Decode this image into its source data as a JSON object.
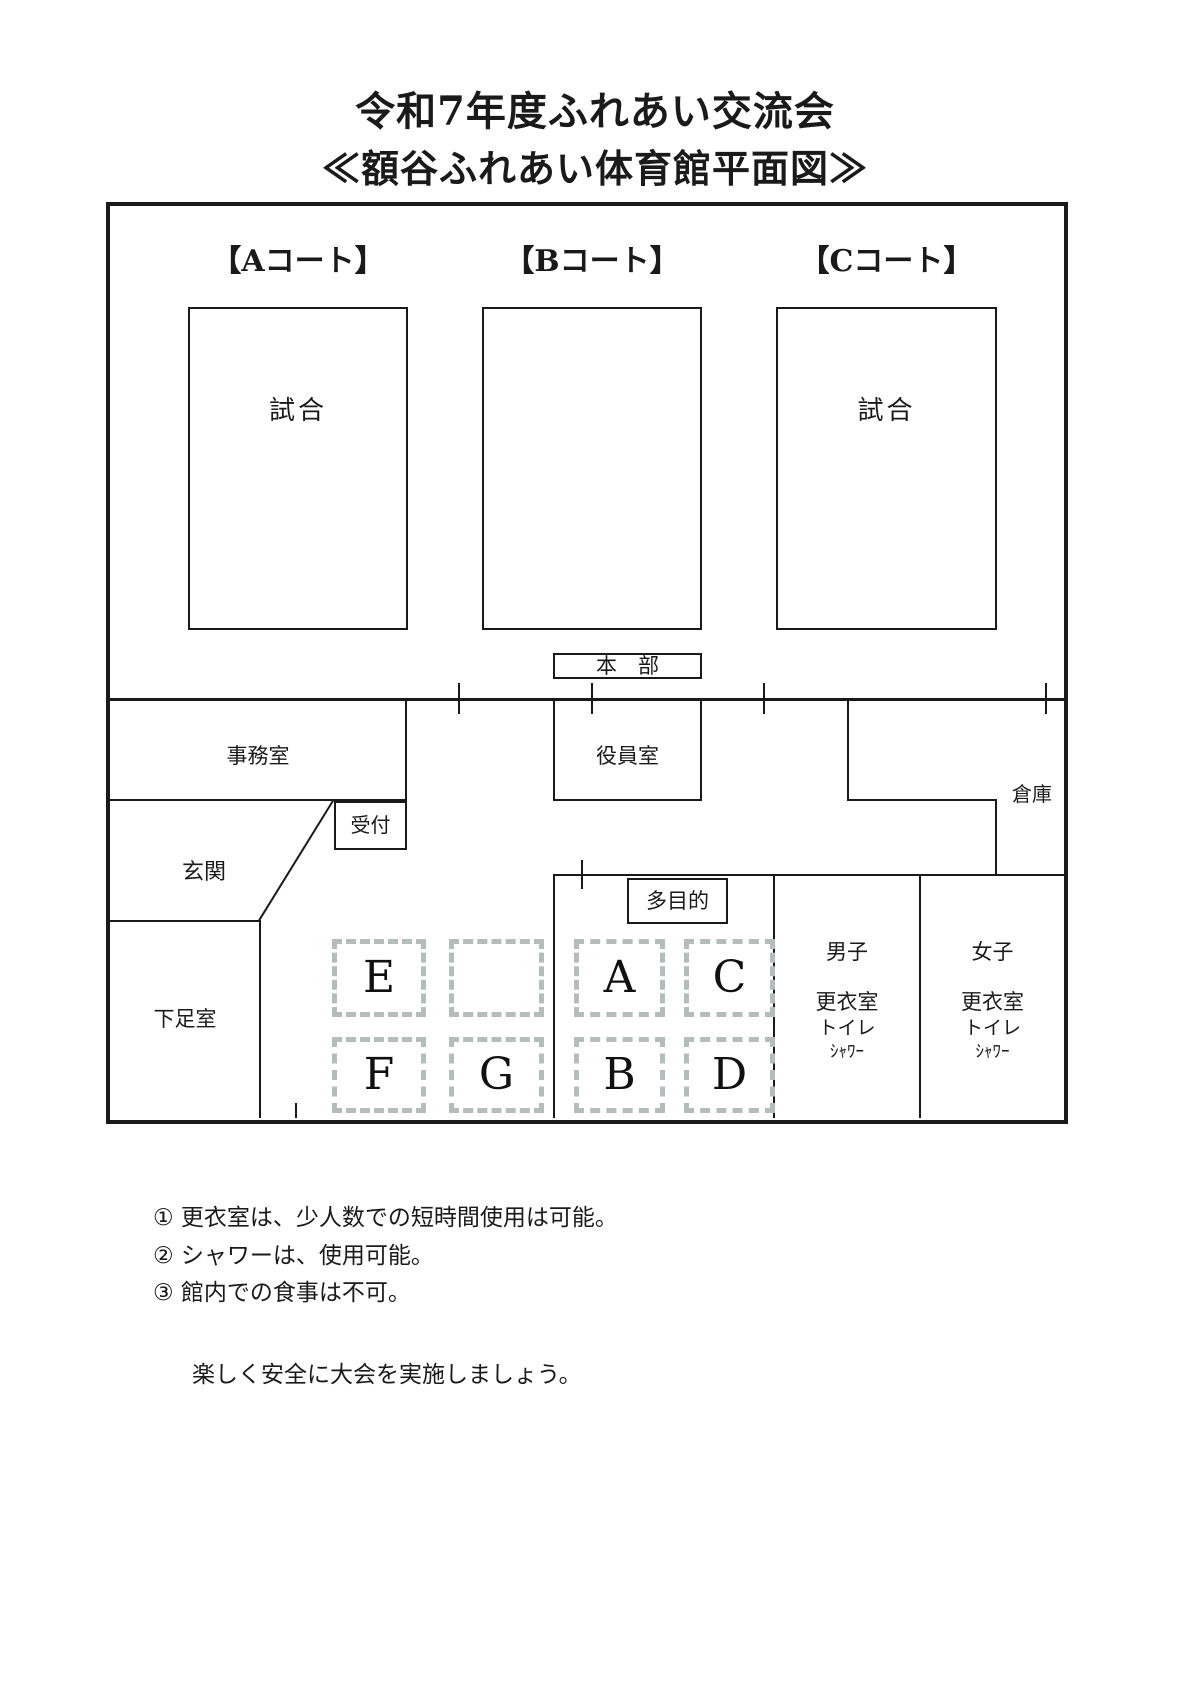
{
  "page": {
    "title": "令和7年度ふれあい交流会",
    "subtitle": "≪額谷ふれあい体育館平面図≫"
  },
  "courts": {
    "a": {
      "label": "【Aコート】",
      "match": "試合"
    },
    "b": {
      "label": "【Bコート】",
      "match": ""
    },
    "c": {
      "label": "【Cコート】",
      "match": "試合"
    }
  },
  "rooms": {
    "headquarters": "本　部",
    "office": "事務室",
    "officers": "役員室",
    "storage": "倉庫",
    "reception": "受付",
    "entrance": "玄関",
    "shoe_room": "下足室",
    "multipurpose": "多目的"
  },
  "changing_rooms": {
    "men": {
      "title": "男子",
      "lines": [
        "更衣室",
        "トイレ",
        "ｼｬﾜｰ"
      ]
    },
    "women": {
      "title": "女子",
      "lines": [
        "更衣室",
        "トイレ",
        "ｼｬﾜｰ"
      ]
    }
  },
  "zones": {
    "a": "A",
    "b": "B",
    "c": "C",
    "d": "D",
    "e": "E",
    "f": "F",
    "g": "G"
  },
  "notes": [
    "① 更衣室は、少人数での短時間使用は可能。",
    "② シャワーは、使用可能。",
    "③ 館内での食事は不可。"
  ],
  "closing": "楽しく安全に大会を実施しましょう。",
  "colors": {
    "line": "#1a1a1a",
    "zone_dash": "#b5bcba"
  }
}
